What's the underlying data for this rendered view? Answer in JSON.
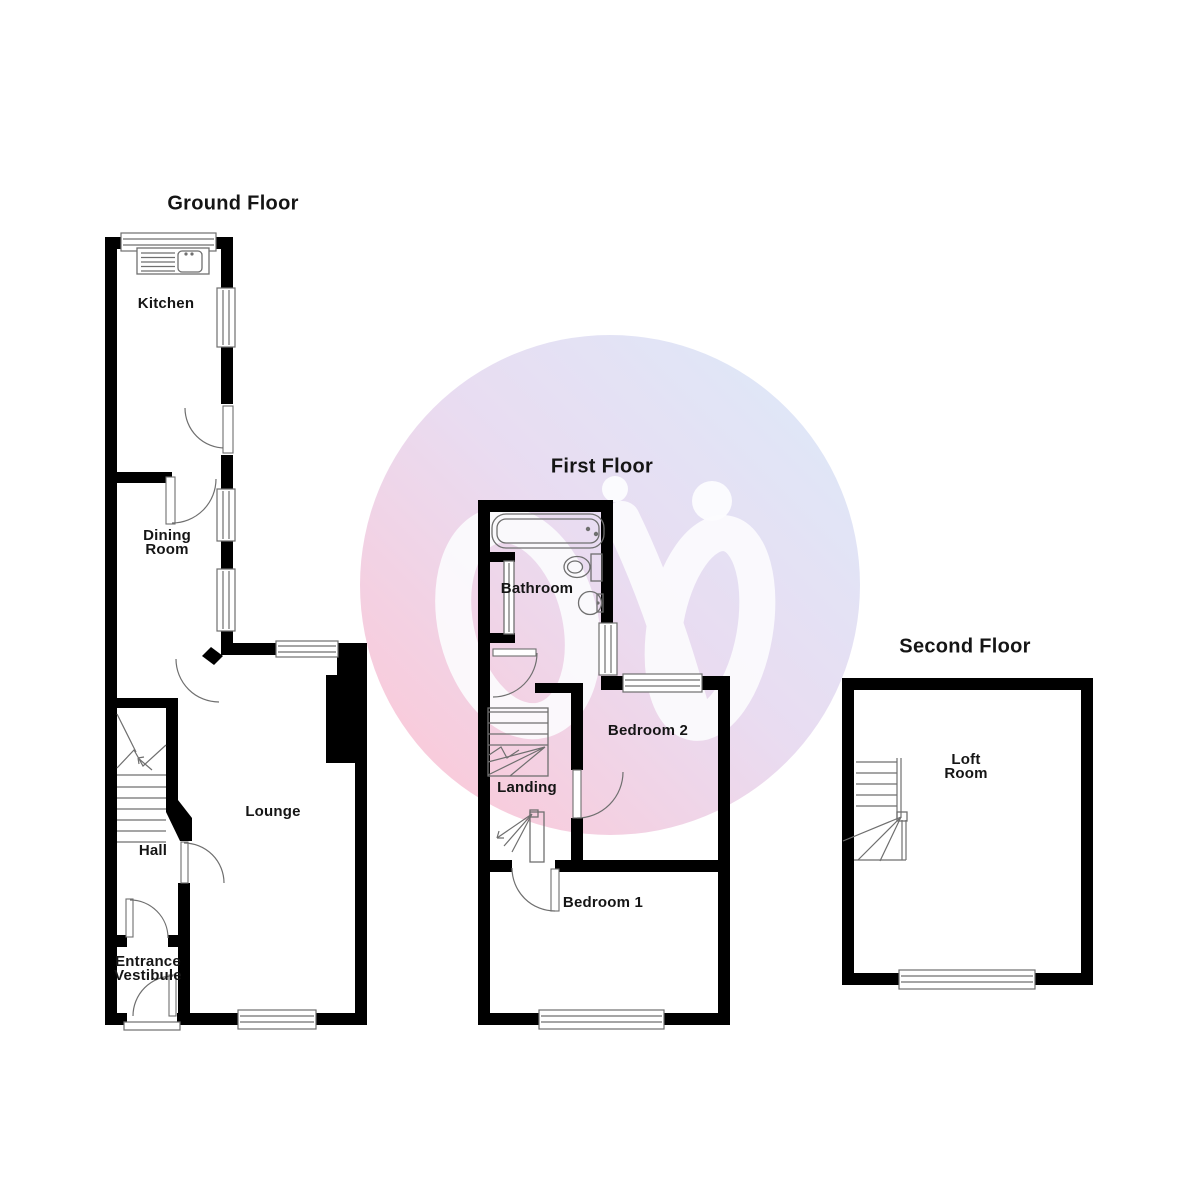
{
  "document": {
    "type": "floorplan",
    "plans_count": 3
  },
  "colors": {
    "wall": "#000000",
    "line": "#6f6f6f",
    "text": "#151515",
    "background": "#ffffff",
    "watermark_blue": "#dee8f8",
    "watermark_lavender": "#e9dcf1",
    "watermark_pink": "#f8ccdc",
    "logo_white": "#fcfcfe"
  },
  "watermark": {
    "icon": "two-figures-logo-icon",
    "shape": "circle"
  },
  "floors": {
    "ground": {
      "title": "Ground Floor",
      "rooms": {
        "kitchen": "Kitchen",
        "dining": "Dining\nRoom",
        "lounge": "Lounge",
        "hall": "Hall",
        "vestibule": "Entrance\nVestibule"
      }
    },
    "first": {
      "title": "First Floor",
      "rooms": {
        "bathroom": "Bathroom",
        "landing": "Landing",
        "bedroom2": "Bedroom 2",
        "bedroom1": "Bedroom 1"
      }
    },
    "second": {
      "title": "Second Floor",
      "rooms": {
        "loft": "Loft\nRoom"
      }
    }
  }
}
